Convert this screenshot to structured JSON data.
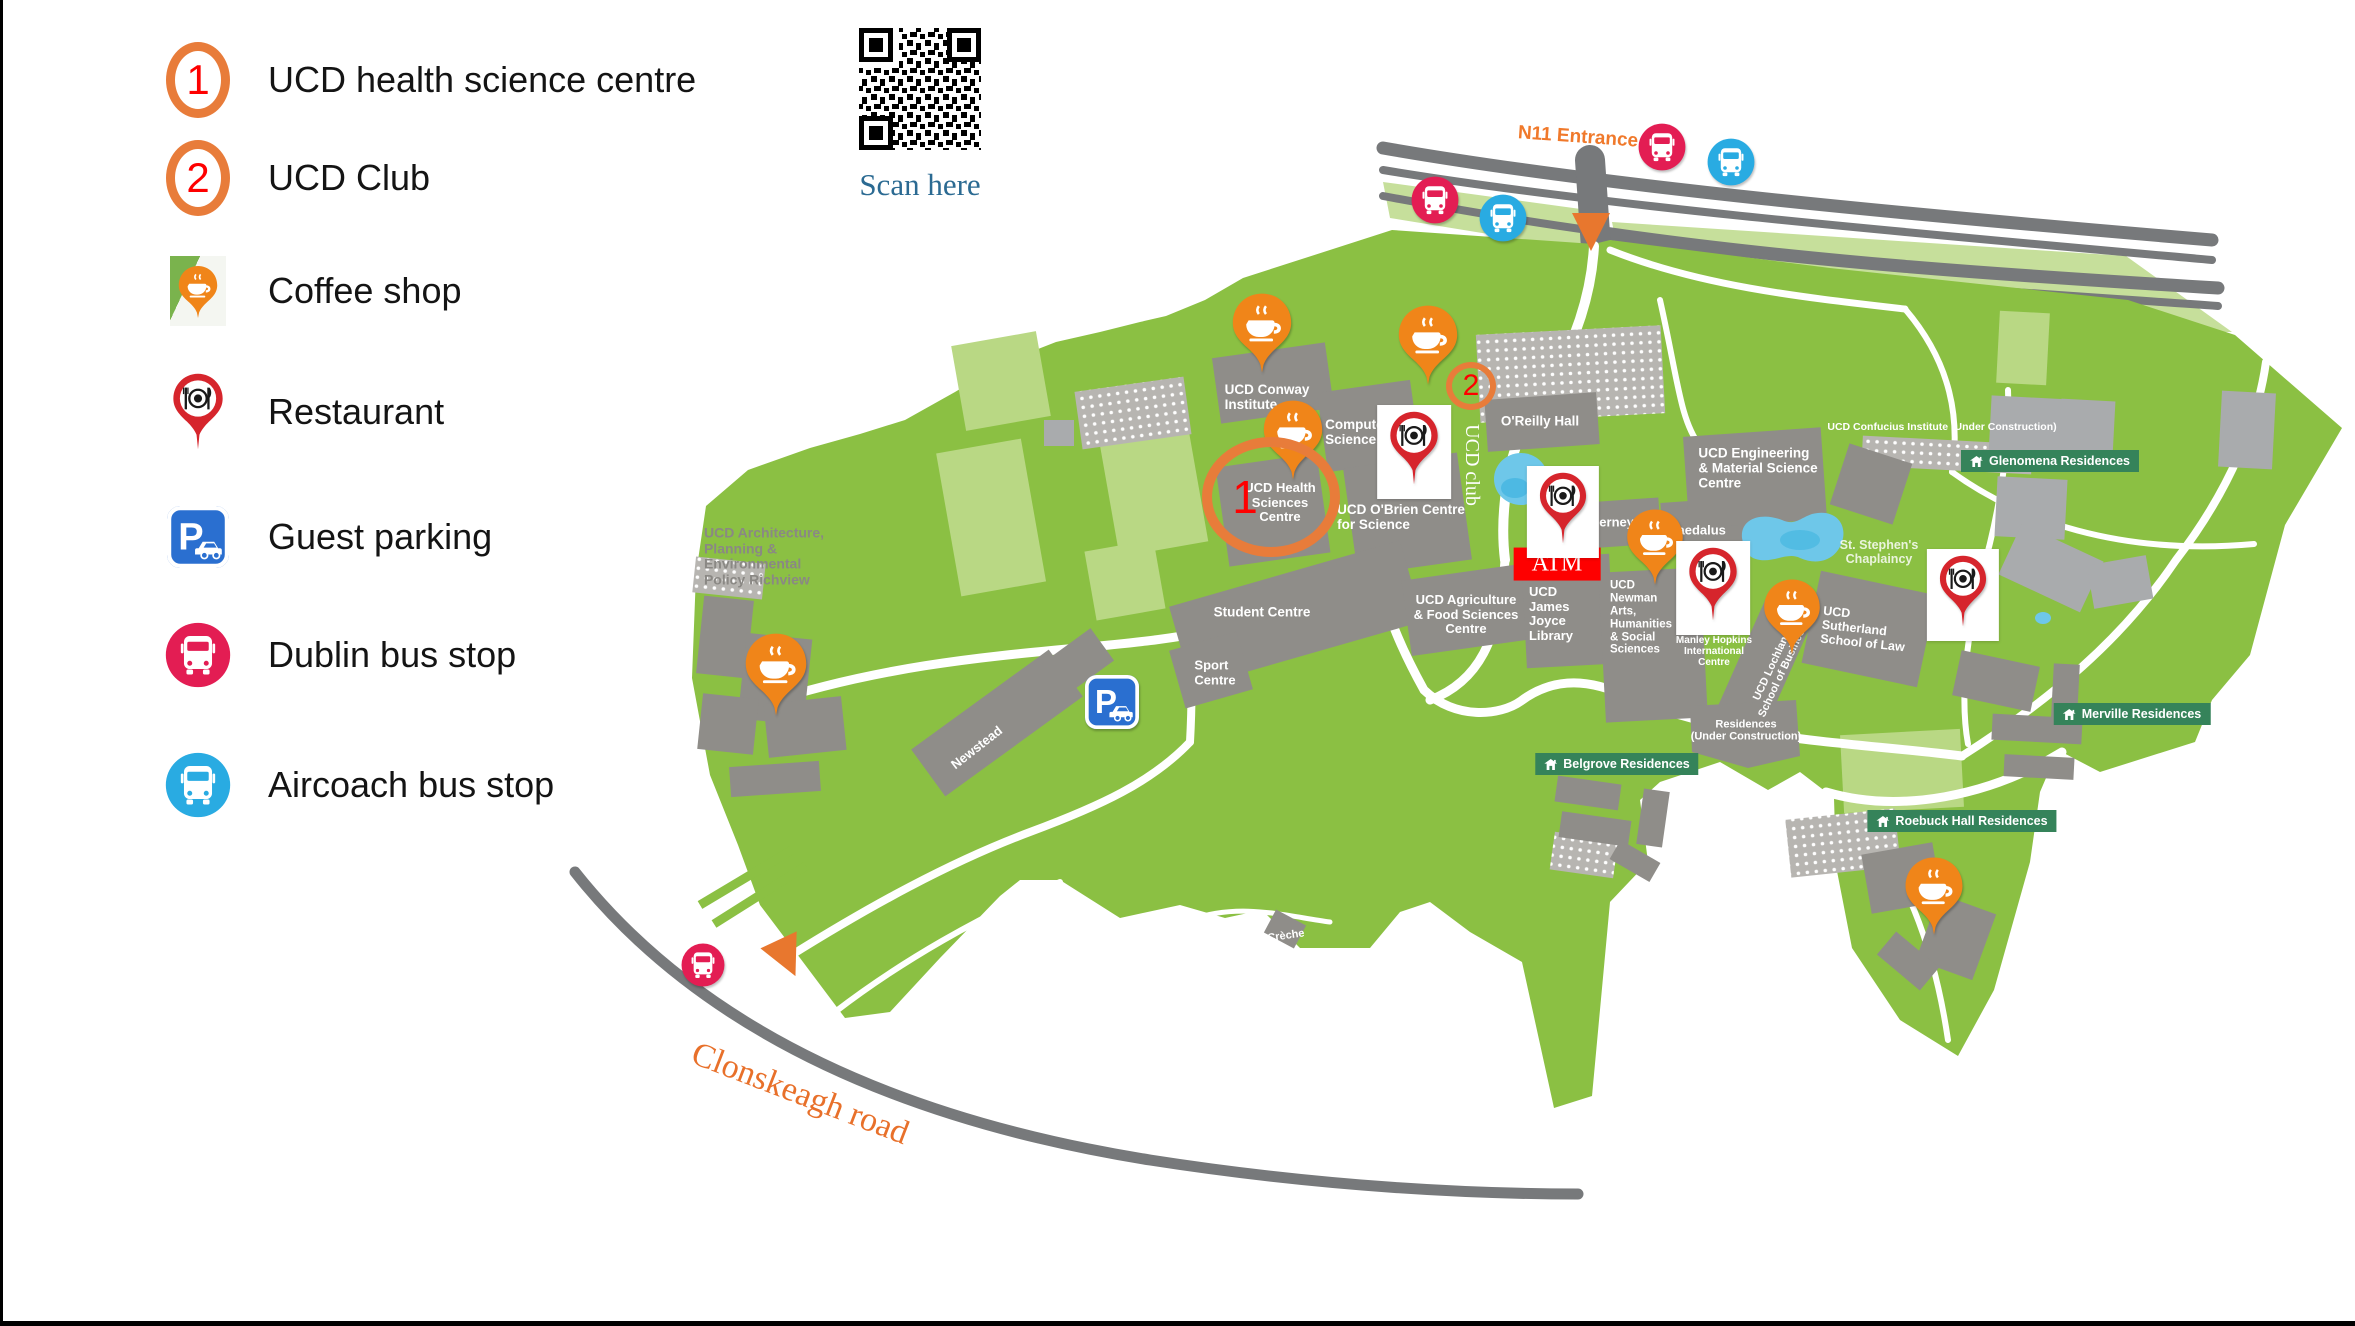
{
  "legend": {
    "items": [
      {
        "label": "UCD health science centre",
        "type": "numbered",
        "number": "1"
      },
      {
        "label": "UCD Club",
        "type": "numbered",
        "number": "2"
      },
      {
        "label": "Coffee shop",
        "type": "coffee"
      },
      {
        "label": "Restaurant",
        "type": "restaurant"
      },
      {
        "label": "Guest parking",
        "type": "parking"
      },
      {
        "label": "Dublin bus stop",
        "type": "dublin-bus"
      },
      {
        "label": "Aircoach bus stop",
        "type": "aircoach-bus"
      }
    ]
  },
  "qr": {
    "caption": "Scan here"
  },
  "icons": {
    "parking_letter": "P"
  },
  "colors": {
    "campus_green": "#8bc043",
    "light_green": "#b9d884",
    "building_gray": "#8f8d89",
    "road_gray": "#77797b",
    "coffee_orange": "#f08519",
    "restaurant_red": "#d6252c",
    "dublin_bus_red": "#e31d53",
    "aircoach_blue": "#29abe2",
    "parking_blue": "#2a6fd0",
    "badge_green": "#35835a",
    "circle_orange": "#e87c3a",
    "number_red": "#fe0000",
    "label_orange": "#f0792b",
    "scan_blue": "#2b6a92",
    "pond_blue": "#6ec7e9",
    "atm_red": "#fe0000"
  },
  "map": {
    "labels": [
      {
        "name": "n11-entrance-label",
        "t": "N11 Entrance",
        "x": 1578,
        "y": 137,
        "s": 19,
        "cls": "n11",
        "rot": 4
      },
      {
        "name": "conway-institute-label",
        "t": "UCD Conway\nInstitute",
        "x": 1267,
        "y": 397,
        "s": 13.5,
        "align": "left"
      },
      {
        "name": "computer-science-label",
        "t": "Computer\nScience",
        "x": 1357,
        "y": 432,
        "s": 13.5,
        "align": "left"
      },
      {
        "name": "oreilly-hall-label",
        "t": "O'Reilly Hall",
        "x": 1540,
        "y": 421,
        "s": 13.5
      },
      {
        "name": "health-sciences-label",
        "t": "UCD Health\nSciences\nCentre",
        "x": 1280,
        "y": 503,
        "s": 13
      },
      {
        "name": "obrien-centre-label",
        "t": "UCD O'Brien Centre\nfor Science",
        "x": 1401,
        "y": 517,
        "s": 13.5,
        "align": "left"
      },
      {
        "name": "agriculture-label",
        "t": "UCD Agriculture\n& Food Sciences\nCentre",
        "x": 1466,
        "y": 615,
        "s": 13
      },
      {
        "name": "james-joyce-library-label",
        "t": "UCD\nJames\nJoyce\nLibrary",
        "x": 1551,
        "y": 614,
        "s": 13,
        "align": "left"
      },
      {
        "name": "student-centre-label",
        "t": "Student Centre",
        "x": 1262,
        "y": 612,
        "s": 13.5
      },
      {
        "name": "sport-centre-label",
        "t": "Sport\nCentre",
        "x": 1215,
        "y": 673,
        "s": 13,
        "align": "left"
      },
      {
        "name": "richview-label",
        "t": "UCD Architecture,\nPlanning &\nEnvironmental\nPolicy Richview",
        "x": 764,
        "y": 557,
        "s": 14,
        "cls": "gray",
        "align": "left"
      },
      {
        "name": "newstead-label",
        "t": "Newstead",
        "x": 977,
        "y": 748,
        "s": 13,
        "rot": -38
      },
      {
        "name": "tierney-label",
        "t": "Tierney",
        "x": 1611,
        "y": 523,
        "s": 13
      },
      {
        "name": "daedalus-label",
        "t": "Daedalus",
        "x": 1697,
        "y": 531,
        "s": 13
      },
      {
        "name": "engineering-label",
        "t": "UCD Engineering\n& Material Science\nCentre",
        "x": 1758,
        "y": 468,
        "s": 13.5,
        "align": "left"
      },
      {
        "name": "confucius-label",
        "t": "UCD Confucius Institute (Under Construction)",
        "x": 1942,
        "y": 428,
        "s": 10.5
      },
      {
        "name": "chaplaincy-label",
        "t": "St. Stephen's\nChaplaincy",
        "x": 1879,
        "y": 552,
        "s": 12.5,
        "cls": "faint"
      },
      {
        "name": "newman-label",
        "t": "UCD\nNewman\nArts,\nHumanities\n& Social\nSciences",
        "x": 1641,
        "y": 618,
        "s": 11.5,
        "align": "left"
      },
      {
        "name": "manley-hopkins-label",
        "t": "Manley Hopkins\nInternational\nCentre",
        "x": 1714,
        "y": 652,
        "s": 10
      },
      {
        "name": "lochlann-business-label",
        "t": "UCD Lochlann\nSchool of Business",
        "x": 1778,
        "y": 668,
        "s": 11,
        "rot": -65
      },
      {
        "name": "sutherland-label",
        "t": "UCD\nSutherland\nSchool of Law",
        "x": 1864,
        "y": 629,
        "s": 12.5,
        "align": "left",
        "rot": 6
      },
      {
        "name": "residences-construction-label",
        "t": "Residences\n(Under Construction)",
        "x": 1746,
        "y": 731,
        "s": 11
      },
      {
        "name": "creche-label",
        "t": "Crèche",
        "x": 1286,
        "y": 936,
        "s": 11,
        "rot": -8
      },
      {
        "name": "atm-label",
        "t": "ATM",
        "x": 1557,
        "y": 564,
        "s": 24,
        "cls": "atm"
      },
      {
        "name": "ucd-club-vertical-label",
        "t": "UCD club",
        "x": 1472,
        "y": 465,
        "s": 20,
        "cls": "vclub",
        "rot": 90
      },
      {
        "name": "clonskeagh-road-label",
        "t": "Clonskeagh road",
        "x": 800,
        "y": 1094,
        "s": 34,
        "cls": "road-label",
        "rot": 21
      }
    ],
    "badges": [
      {
        "name": "glenomena-residences-badge",
        "text": "Glenomena Residences",
        "x": 2050,
        "y": 461
      },
      {
        "name": "merville-residences-badge",
        "text": "Merville Residences",
        "x": 2132,
        "y": 714
      },
      {
        "name": "roebuck-hall-residences-badge",
        "text": "Roebuck Hall Residences",
        "x": 1962,
        "y": 821
      },
      {
        "name": "belgrove-residences-badge",
        "text": "Belgrove Residences",
        "x": 1617,
        "y": 764
      }
    ],
    "markers": [
      {
        "type": "coffee",
        "name": "coffee-pin-conway",
        "x": 1262,
        "y": 374,
        "s": 82
      },
      {
        "type": "coffee",
        "name": "coffee-pin-health-sciences",
        "x": 1293,
        "y": 481,
        "s": 82
      },
      {
        "type": "coffee",
        "name": "coffee-pin-centre",
        "x": 1428,
        "y": 386,
        "s": 82
      },
      {
        "type": "coffee",
        "name": "coffee-pin-richview",
        "x": 776,
        "y": 717,
        "s": 85
      },
      {
        "type": "coffee",
        "name": "coffee-pin-daedalus",
        "x": 1655,
        "y": 586,
        "s": 78
      },
      {
        "type": "coffee",
        "name": "coffee-pin-business",
        "x": 1792,
        "y": 656,
        "s": 78
      },
      {
        "type": "coffee",
        "name": "coffee-pin-roebuck",
        "x": 1934,
        "y": 936,
        "s": 80
      },
      {
        "type": "restaurant-box",
        "name": "restaurant-pin-obrien",
        "x": 1414,
        "y": 452,
        "s": 78
      },
      {
        "type": "restaurant-box",
        "name": "restaurant-pin-atm",
        "x": 1563,
        "y": 512,
        "s": 76
      },
      {
        "type": "restaurant-box",
        "name": "restaurant-pin-manley-hopkins",
        "x": 1713,
        "y": 588,
        "s": 78
      },
      {
        "type": "restaurant-box",
        "name": "restaurant-pin-glenomena",
        "x": 1963,
        "y": 595,
        "s": 76
      },
      {
        "type": "bus-red",
        "name": "dublin-bus-stop-n11-west",
        "x": 1435,
        "y": 200,
        "s": 48
      },
      {
        "type": "bus-red",
        "name": "dublin-bus-stop-n11-east",
        "x": 1662,
        "y": 147,
        "s": 48
      },
      {
        "type": "bus-red",
        "name": "dublin-bus-stop-clonskeagh",
        "x": 703,
        "y": 965,
        "s": 44
      },
      {
        "type": "bus-blue",
        "name": "aircoach-stop-n11-west",
        "x": 1503,
        "y": 218,
        "s": 48
      },
      {
        "type": "bus-blue",
        "name": "aircoach-stop-n11-east",
        "x": 1731,
        "y": 162,
        "s": 48
      },
      {
        "type": "parking",
        "name": "guest-parking-marker",
        "x": 1112,
        "y": 702,
        "s": 54
      },
      {
        "type": "triangle",
        "name": "entrance-triangle-n11",
        "x": 1591,
        "y": 232,
        "s": 38
      },
      {
        "type": "triangle",
        "name": "entrance-triangle-clonskeagh",
        "x": 787,
        "y": 958,
        "s": 40,
        "rot": -25
      }
    ],
    "circles": [
      {
        "number": "1",
        "x": 1271,
        "y": 497,
        "rx": 59,
        "ry": 50,
        "bw": 10,
        "fs": 46,
        "ox": -26
      },
      {
        "number": "2",
        "x": 1471,
        "y": 386,
        "rx": 19,
        "ry": 18,
        "bw": 6,
        "fs": 30,
        "ox": 0
      }
    ]
  }
}
